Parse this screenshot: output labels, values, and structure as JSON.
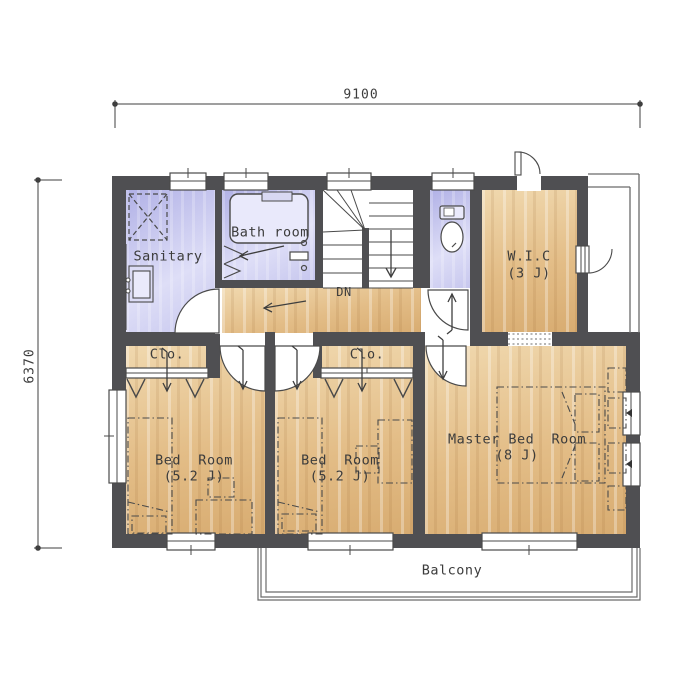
{
  "dimensions": {
    "width": "9100",
    "depth": "6370"
  },
  "rooms": {
    "sanitary": {
      "name": "Sanitary"
    },
    "bath": {
      "name": "Bath room"
    },
    "wic": {
      "name": "W.I.C",
      "size": "(3 J)"
    },
    "closet_left": {
      "name": "Clo."
    },
    "closet_middle": {
      "name": "Clo."
    },
    "bedroom_left": {
      "name": "Bed  Room",
      "size": "(5.2 J)"
    },
    "bedroom_middle": {
      "name": "Bed  Room",
      "size": "(5.2 J)"
    },
    "master_bedroom": {
      "name": "Master Bed  Room",
      "size": "(8 J)"
    },
    "balcony": {
      "name": "Balcony"
    }
  },
  "stairs": {
    "down_label": "DN"
  },
  "colors": {
    "wall": "#4f4f52",
    "wet_room": "#c9c9ef",
    "wood_floor": "#e3bd87",
    "linework": "#3f3f3f"
  }
}
